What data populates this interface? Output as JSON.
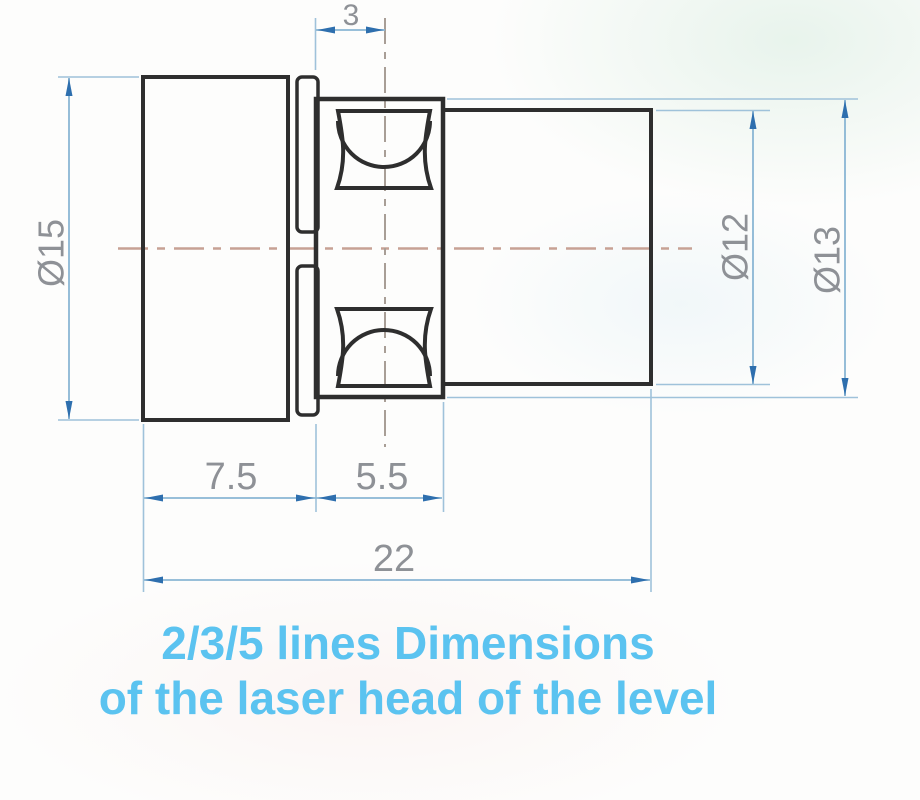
{
  "drawing": {
    "caption": {
      "line1": "2/3/5 lines Dimensions",
      "line2": "of the laser head of the level"
    },
    "dimensions": {
      "lens_offset": "3",
      "body_diameter": "Ø15",
      "cylinder_diameter": "Ø12",
      "housing_diameter": "Ø13",
      "body_length": "7.5",
      "housing_length": "5.5",
      "total_length": "22"
    },
    "colors": {
      "part_outline": "#2e2e2e",
      "dimension_line": "#8ab6d4",
      "arrowhead": "#2e6fae",
      "dimension_text": "#8e9196",
      "centerline": "#c7a194",
      "caption_text": "#5bc3f0",
      "background": "#fdfdfc"
    }
  }
}
